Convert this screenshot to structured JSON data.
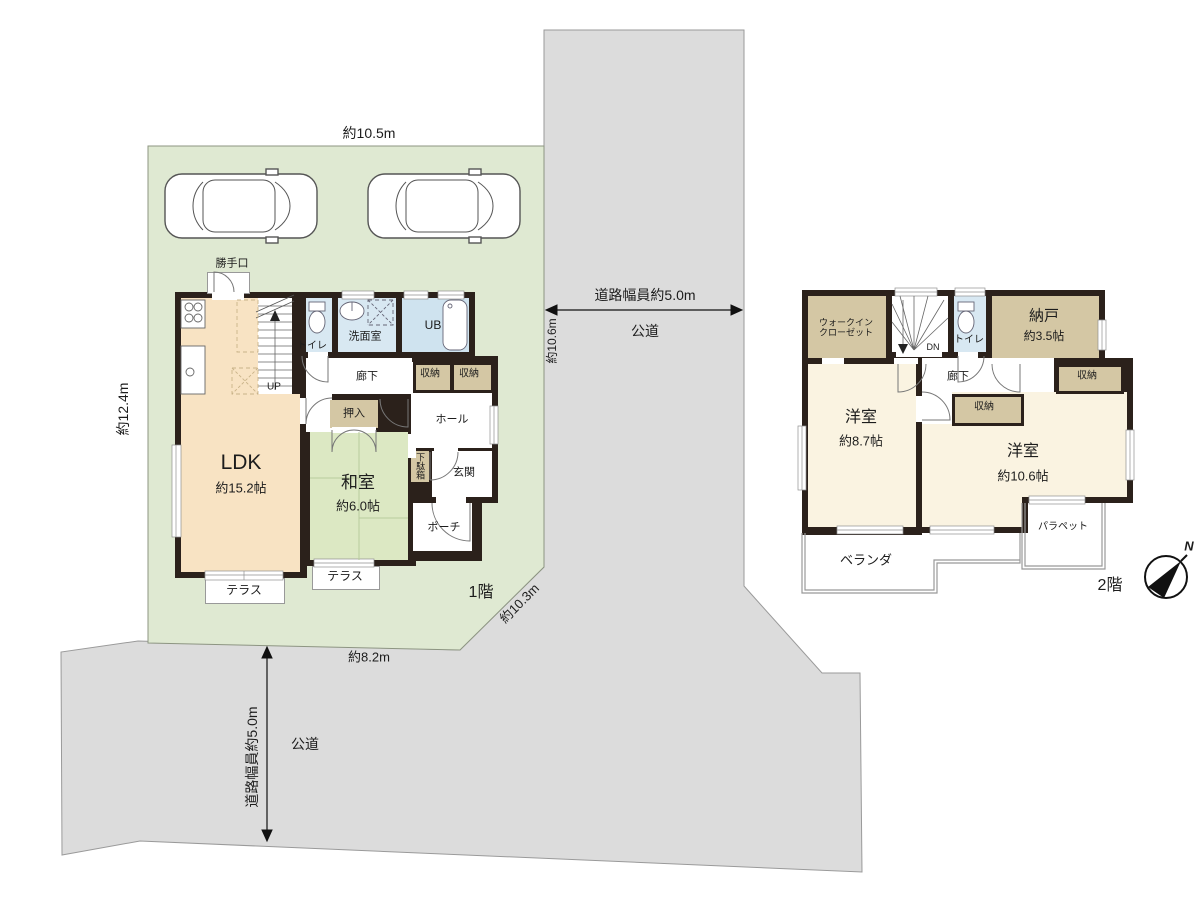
{
  "site": {
    "dim_top": "約10.5m",
    "dim_left": "約12.4m",
    "dim_diagonal": "約10.3m",
    "dim_bottom": "約8.2m",
    "road_right": {
      "width_label": "道路幅員約5.0m",
      "length_label": "約10.6m",
      "type": "公道"
    },
    "road_bottom": {
      "width_label": "道路幅員約5.0m",
      "type": "公道"
    },
    "colors": {
      "lot": "#dfe9d2",
      "road": "#dcdcdc",
      "wall": "#2b211b",
      "ldk": "#f8e3c3",
      "tatami": "#dce8c3",
      "water": "#d8e8f2",
      "storage": "#d4c7a4",
      "bedroom": "#faf3e1"
    }
  },
  "floor1": {
    "label": "1階",
    "rooms": {
      "katteguchi": "勝手口",
      "toilet": "トイレ",
      "washroom": "洗面室",
      "bath": "UB",
      "corridor": "廊下",
      "storage_a": "収納",
      "storage_b": "収納",
      "hall": "ホール",
      "oshiire": "押入",
      "ldk_name": "LDK",
      "ldk_size": "約15.2帖",
      "washitsu_name": "和室",
      "washitsu_size": "約6.0帖",
      "getabako": "下駄箱",
      "genkan": "玄関",
      "porch": "ポーチ",
      "terrace_a": "テラス",
      "terrace_b": "テラス",
      "stairs": "UP"
    }
  },
  "floor2": {
    "label": "2階",
    "rooms": {
      "wic": "ウォークイン\nクローゼット",
      "stairs": "DN",
      "toilet": "トイレ",
      "nando_name": "納戸",
      "nando_size": "約3.5帖",
      "corridor": "廊下",
      "storage_a": "収納",
      "storage_b": "収納",
      "bedroom_a_name": "洋室",
      "bedroom_a_size": "約8.7帖",
      "bedroom_b_name": "洋室",
      "bedroom_b_size": "約10.6帖",
      "veranda": "ベランダ",
      "parapet": "パラペット"
    }
  },
  "compass": {
    "north": "N"
  }
}
